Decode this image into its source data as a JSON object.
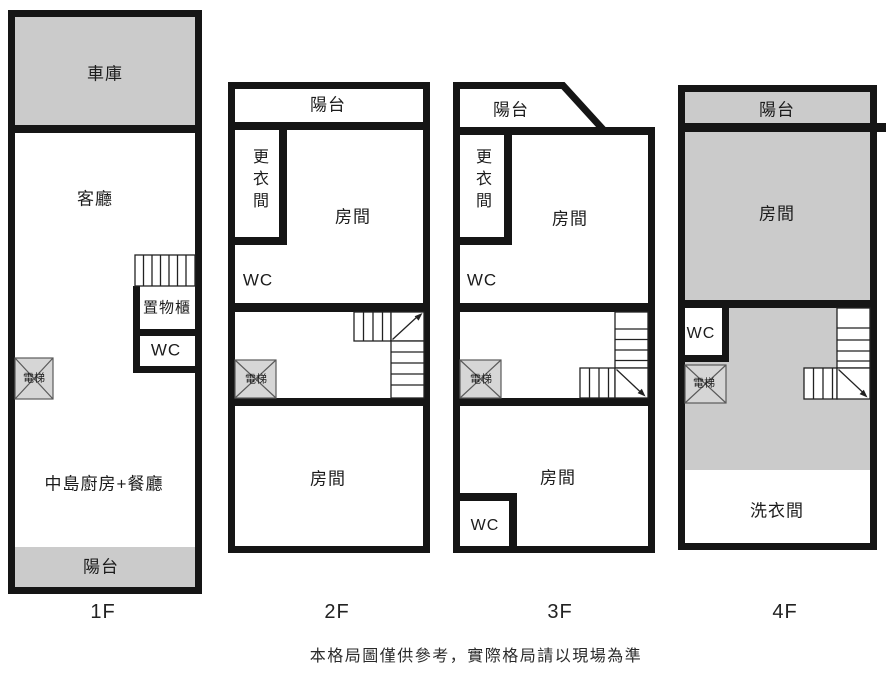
{
  "caption": "本格局圖僅供參考，實際格局請以現場為準",
  "colors": {
    "wall": "#151515",
    "room_gray": "#cbcbcb",
    "elevator_fill": "#d6d6d6",
    "stair_line": "#222222"
  },
  "floors": {
    "f1": {
      "label": "1F",
      "garage": "車庫",
      "living": "客廳",
      "storage": "置物櫃",
      "wc": "WC",
      "elevator": "電梯",
      "kitchen": "中島廚房+餐廳",
      "balcony": "陽台"
    },
    "f2": {
      "label": "2F",
      "balcony": "陽台",
      "dressing": "更衣間",
      "wc": "WC",
      "room_top": "房間",
      "elevator": "電梯",
      "room_bottom": "房間"
    },
    "f3": {
      "label": "3F",
      "balcony": "陽台",
      "dressing": "更衣間",
      "wc": "WC",
      "room_top": "房間",
      "elevator": "電梯",
      "room_bottom": "房間",
      "wc_bottom": "WC"
    },
    "f4": {
      "label": "4F",
      "balcony": "陽台",
      "room": "房間",
      "wc": "WC",
      "elevator": "電梯",
      "laundry": "洗衣間"
    }
  }
}
